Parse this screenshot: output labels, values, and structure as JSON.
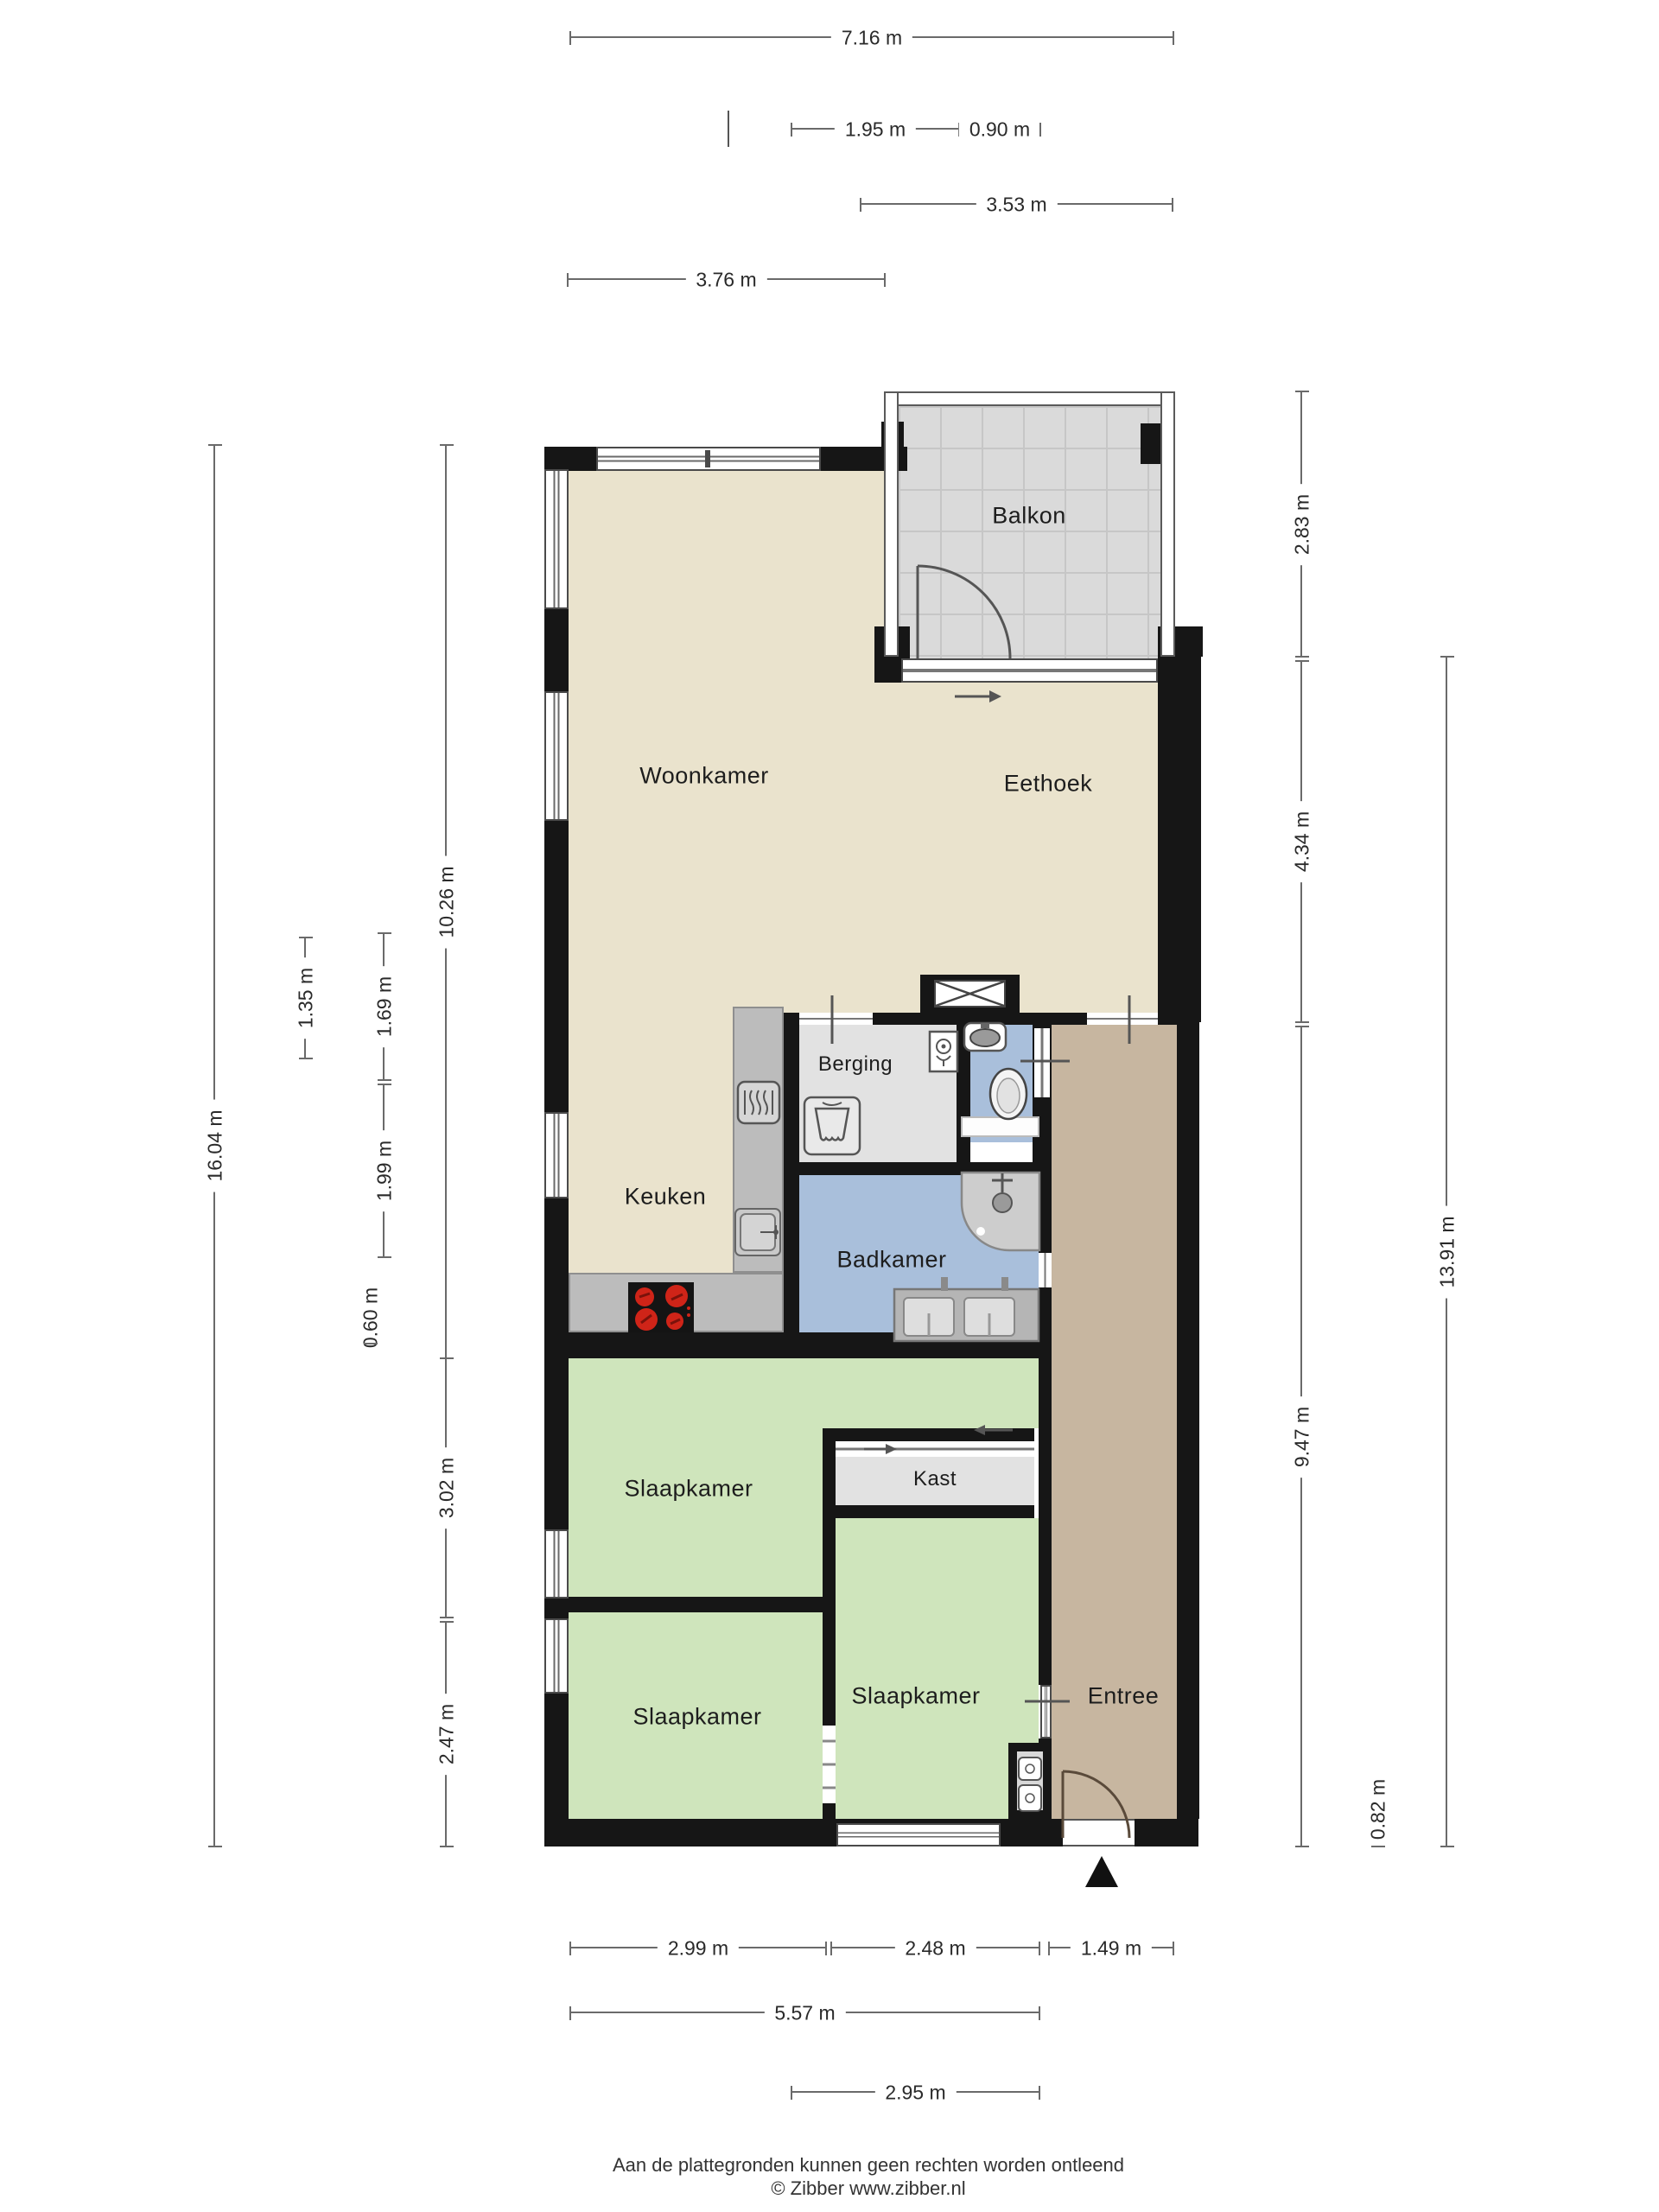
{
  "plan": {
    "type": "floorplan",
    "source_note": "apartment floor plan with balcony",
    "rooms": {
      "balkon": "Balkon",
      "woonkamer": "Woonkamer",
      "eethoek": "Eethoek",
      "berging": "Berging",
      "keuken": "Keuken",
      "badkamer": "Badkamer",
      "slaapkamer_1": "Slaapkamer",
      "kast": "Kast",
      "slaapkamer_2": "Slaapkamer",
      "slaapkamer_3": "Slaapkamer",
      "entree": "Entree"
    },
    "dims": {
      "top": [
        "7.16 m",
        "1.95 m",
        "0.90 m",
        "3.53 m",
        "3.76 m"
      ],
      "left": [
        "16.04 m",
        "10.26 m",
        "1.35 m",
        "1.69 m",
        "1.99 m",
        "0.60 m",
        "3.02 m",
        "2.47 m"
      ],
      "right": [
        "2.83 m",
        "4.34 m",
        "13.91 m",
        "9.47 m",
        "0.82 m"
      ],
      "bottom": [
        "2.99 m",
        "2.48 m",
        "1.49 m",
        "5.57 m",
        "2.95 m"
      ]
    },
    "icons": {
      "north_arrow": "north-arrow-triangle",
      "shaft_cross": "ventilation-shaft-x",
      "door_swing": "quarter-circle-door-swing",
      "sliding_arrow": "sliding-door-arrow",
      "cooktop": "4-burner-cooktop",
      "oven": "built-in-oven",
      "kitchen_sink": "kitchen-sink",
      "washing_machine": "washing-machine",
      "toilet": "toilet",
      "hand_basin": "hand-basin",
      "toilet_roll": "toilet-roll-holder",
      "shower": "shower-with-mixer",
      "double_vanity": "double-washbasin"
    },
    "colors": {
      "wall": "#161616",
      "floor_living": "#eae3cd",
      "floor_bedroom": "#cfe5bc",
      "floor_bath": "#a9bfdb",
      "floor_entree": "#c7b6a0",
      "floor_storage": "#e2e2e2",
      "floor_balcony": "#dadada",
      "cooktop_burner": "#cf2418",
      "dim_line": "#6a6a6a"
    },
    "footer": {
      "line1": "Aan de plattegronden kunnen geen rechten worden ontleend",
      "line2": "© Zibber www.zibber.nl"
    }
  }
}
